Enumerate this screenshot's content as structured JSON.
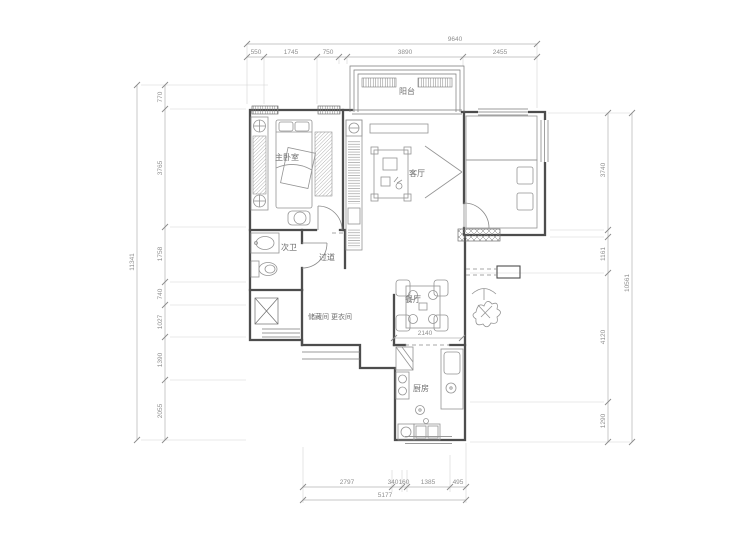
{
  "canvas": {
    "width": 740,
    "height": 555,
    "background": "#ffffff",
    "wall_color": "#4d4d4d",
    "dim_color": "#8f8f8f"
  },
  "rooms": {
    "master_bedroom": {
      "label": "主卧室"
    },
    "balcony": {
      "label": "阳台"
    },
    "living_room": {
      "label": "客厅"
    },
    "second_bathroom": {
      "label": "次卫"
    },
    "hallway": {
      "label": "过道"
    },
    "storage_dressing": {
      "label": "储藏间 更衣间"
    },
    "dining_room": {
      "label": "餐厅"
    },
    "kitchen": {
      "label": "厨房"
    }
  },
  "dimensions": {
    "top": {
      "total": "9640",
      "segments": [
        "550",
        "1745",
        "750",
        "3890",
        "2455"
      ]
    },
    "left": {
      "total": "11341",
      "segments": [
        "770",
        "3765",
        "1758",
        "740",
        "1027",
        "1390",
        "2055"
      ]
    },
    "right": {
      "total": "10561",
      "segments": [
        "3740",
        "1161",
        "4120",
        "1290"
      ]
    },
    "bottom": {
      "total": "5177",
      "segments": [
        "2797",
        "340",
        "160",
        "1385",
        "495"
      ]
    },
    "interior": {
      "dining_width": "2140"
    }
  }
}
